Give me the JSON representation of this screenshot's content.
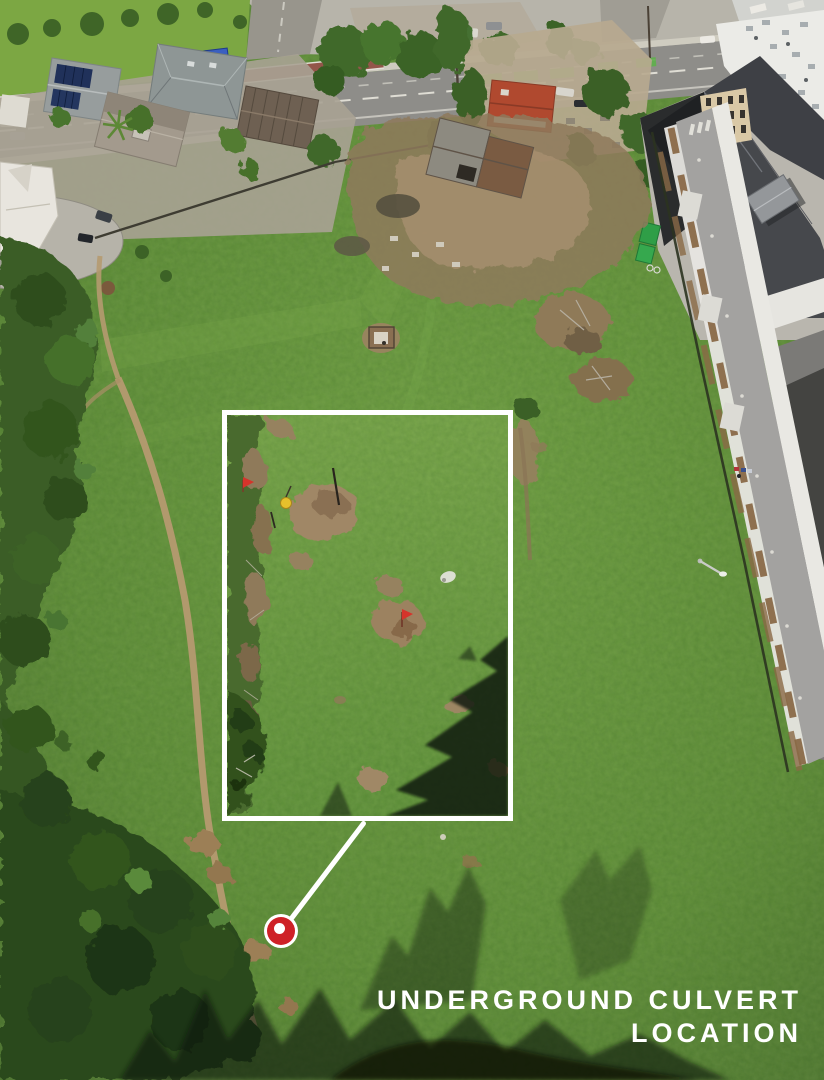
{
  "caption": {
    "line1": "UNDERGROUND CULVERT",
    "line2": "LOCATION"
  },
  "annotation": {
    "marker": "culvert-location-marker",
    "marker_color": "#ce2127",
    "leader_line_color": "#ffffff",
    "callout_border_color": "#ffffff"
  }
}
